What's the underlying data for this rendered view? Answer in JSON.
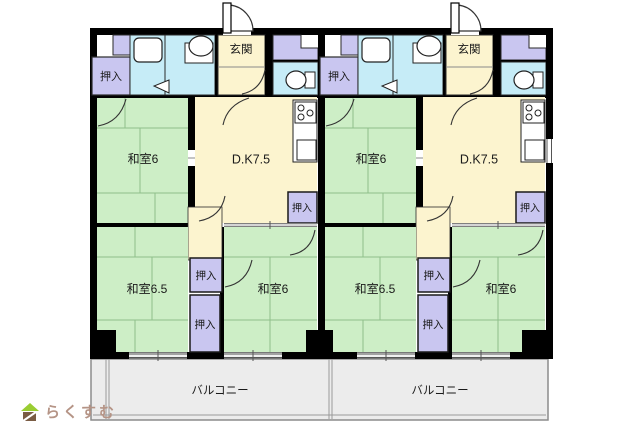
{
  "plan": {
    "units": [
      {
        "genkan": "玄関",
        "washitsu_top": "和室6",
        "dk": "D.K7.5",
        "washitsu_bottom_left": "和室6.5",
        "washitsu_bottom_right": "和室6",
        "closet_entry": "押入",
        "closet_dk": "押入",
        "closet_mid": "押入",
        "closet_bottom": "押入",
        "balcony": "バルコニー"
      },
      {
        "genkan": "玄関",
        "washitsu_top": "和室6",
        "dk": "D.K7.5",
        "washitsu_bottom_left": "和室6.5",
        "washitsu_bottom_right": "和室6",
        "closet_entry": "押入",
        "closet_dk": "押入",
        "closet_mid": "押入",
        "closet_bottom": "押入",
        "balcony": "バルコニー"
      }
    ]
  },
  "logo": {
    "text": "らくすむ"
  },
  "colors": {
    "tatami_green": "#cdeec6",
    "dining_cream": "#fcf4cf",
    "closet_purple": "#c9c6f0",
    "wet_area_cyan": "#c6ecf7",
    "balcony_gray": "#ececec",
    "wall_black": "#000000",
    "balcony_text": "#8a8a8a",
    "logo_text": "#b59486",
    "logo_roof_green": "#9acd32",
    "logo_body_brown": "#7a5c44"
  }
}
